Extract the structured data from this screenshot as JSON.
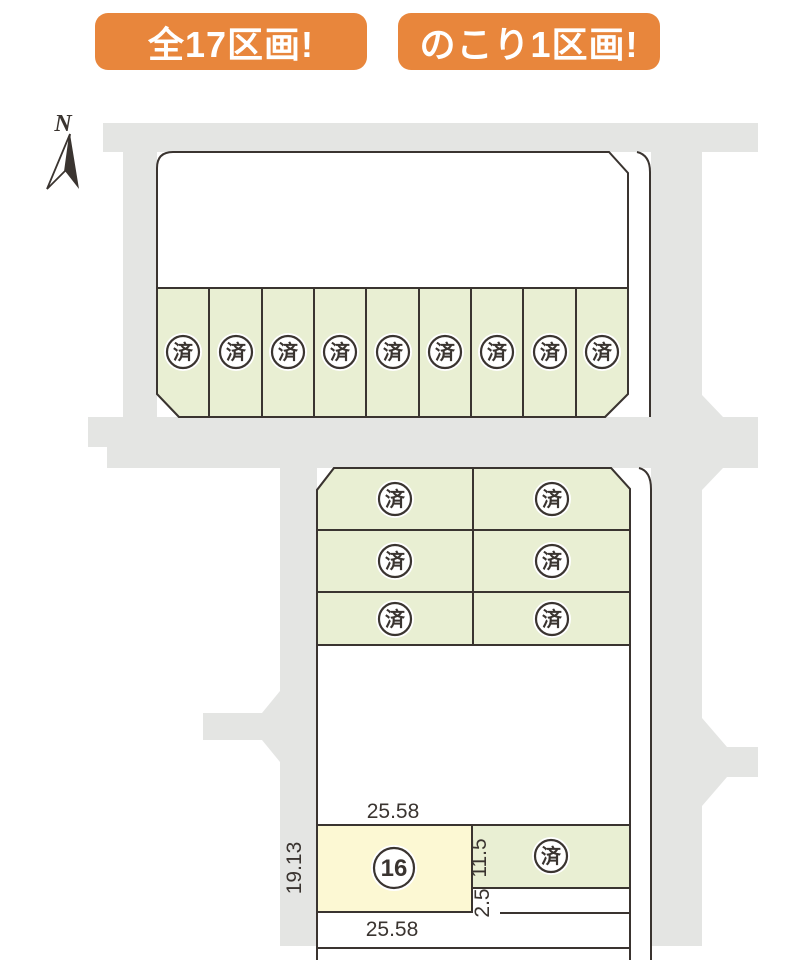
{
  "badges": {
    "total": {
      "label": "全17区画!"
    },
    "remaining": {
      "label": "のこり1区画!"
    }
  },
  "compass": {
    "north_label": "N"
  },
  "map": {
    "sold_mark": "済",
    "available_lot": {
      "number": "16"
    },
    "dimensions": {
      "width_top": "25.58",
      "width_bottom": "25.58",
      "depth_left": "19.13",
      "depth_right": "11.5",
      "path_width": "2.5"
    }
  },
  "colors": {
    "road": "#e4e5e3",
    "plot_green": "#e9efd3",
    "plot_yellow": "#fcf8d3",
    "line": "#3a3430",
    "badge_orange": "#e8863c",
    "badge_text": "#ffffff",
    "background": "#ffffff"
  }
}
